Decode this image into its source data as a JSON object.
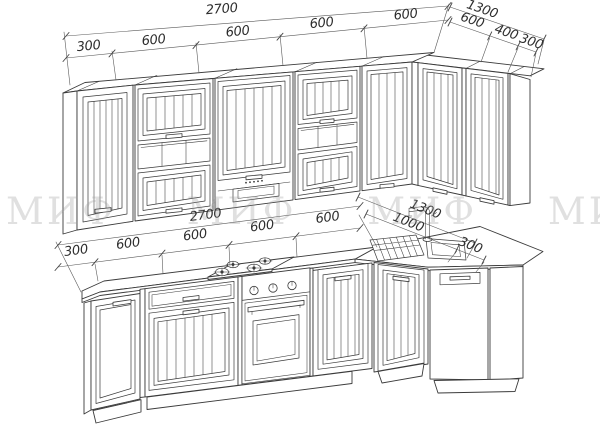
{
  "title": "L-shaped kitchen technical drawing",
  "watermark": {
    "text": "МИФ МИФ МИФ МИФ"
  },
  "colors": {
    "line": "#3b3b3b",
    "background": "#ffffff",
    "watermark": "#9a9a9a"
  },
  "dims": {
    "upper_cabinets": {
      "overall_left": "2700",
      "overall_right": "1300",
      "segments_left": [
        "300",
        "600",
        "600",
        "600",
        "600"
      ],
      "segments_right": [
        "600",
        "400",
        "300"
      ]
    },
    "base_cabinets": {
      "overall_left": "2700",
      "overall_right": "1300",
      "segments_left": [
        "300",
        "600",
        "600",
        "600",
        "600"
      ],
      "segments_right": [
        "1000",
        "300"
      ]
    }
  }
}
